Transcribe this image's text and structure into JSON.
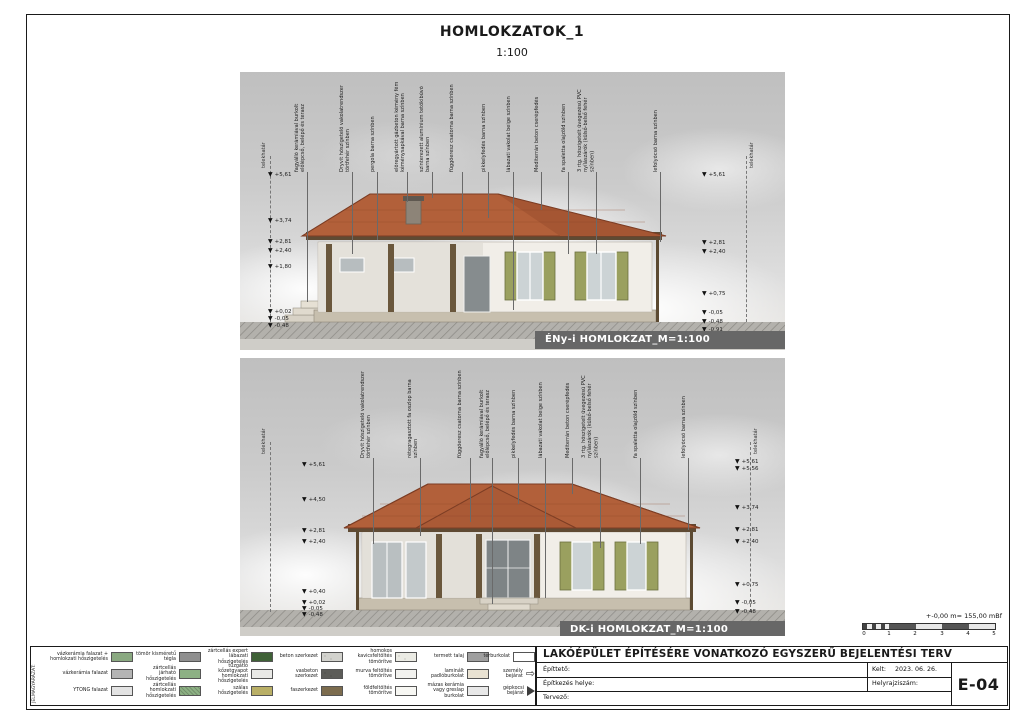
{
  "sheet": {
    "title": "HOMLOKZATOK_1",
    "scale": "1:100",
    "sheet_number": "E-04",
    "datum_note": "+-0,00 m= 155,00 mBf"
  },
  "icons": {
    "level_marker_glyph": "▼",
    "person_entrance_glyph": "⇨"
  },
  "elevations": [
    {
      "caption": "ÉNy-i HOMLOKZAT_M=1:100",
      "boundary_label": "telekhatár",
      "labels": [
        "fagyálló kerámiával burkolt előlépcső, belépő és terasz",
        "Dryvit hőszigetelő vakolatrendszer törtfehér színben",
        "pergola barna színben",
        "előregyártott gázbeton kémény fém kéménysapkával barna színben",
        "szinterezett alumínium tetőkibúvó barna színben",
        "függőeresz csatorna barna színben",
        "pikkelyfedés barna színben",
        "lábazati vakolat beige színben",
        "Mediterrán beton cserépfedés",
        "fa spaletta olajzöld színben",
        "3 rtg. hőszigetelt üvegezésű PVC nyílászárók (külső-belső fehér színben)",
        "lefolyócső barna színben"
      ],
      "levels_left": [
        "+5,61",
        "+3,74",
        "+2,81",
        "+2,40",
        "+1,80",
        "+0,02",
        "-0,05",
        "-0,48"
      ],
      "levels_right": [
        "+5,61",
        "+2,81",
        "+2,40",
        "+0,75",
        "-0,05",
        "-0,48",
        "-0,91"
      ]
    },
    {
      "caption": "DK-i HOMLOKZAT_M=1:100",
      "boundary_label": "telekhatár",
      "labels": [
        "Dryvit hőszigetelő vakolatrendszer törtfehér színben",
        "rétegragasztott fa oszlop barna színben",
        "függőeresz csatorna barna színben",
        "fagyálló kerámiával burkolt előlépcső, belépő és terasz",
        "pikkelyfedés barna színben",
        "lábazati vakolat beige színben",
        "Mediterrán beton cserépfedés",
        "3 rtg. hőszigetelt üvegezésű PVC nyílászárók (külső-belső fehér színben)",
        "fa spaletta olajzöld színben",
        "lefolyócső barna színben"
      ],
      "levels_left": [
        "+5,61",
        "+4,50",
        "+2,81",
        "+2,40",
        "+0,40",
        "+0,02",
        "-0,05",
        "-0,48"
      ],
      "levels_right": [
        "+5,61",
        "+5,56",
        "+3,74",
        "+2,81",
        "+2,40",
        "+0,75",
        "-0,05",
        "-0,48"
      ]
    }
  ],
  "legend": {
    "heading": "JELMAGYARÁZAT:",
    "items": [
      {
        "label": "vázkerámia falazat + homlokzati hőszigetelés",
        "color": "#8aa981"
      },
      {
        "label": "vázkerámia falazat",
        "color": "#b4b4b4"
      },
      {
        "label": "YTONG falazat",
        "color": "#e3e3e3"
      },
      {
        "label": "tömör kisméretű tégla",
        "color": "#8f8f8f"
      },
      {
        "label": "zártcellás járható hőszigetelés",
        "color": "#8db184"
      },
      {
        "label": "zártcellás homlokzati hőszigetelés",
        "color": "#8db184"
      },
      {
        "label": "zártcellás expert lábazati hőszigetelés",
        "color": "#3f6137"
      },
      {
        "label": "tűzgátló kőzetgyapot homlokzati hőszigetelés",
        "color": "#e9e9e6"
      },
      {
        "label": "szálas hőszigetelés",
        "color": "#b9af66"
      },
      {
        "label": "beton szerkezet",
        "color": "#d2d2cd"
      },
      {
        "label": "vasbeton szerkezet",
        "color": "#5c5c58"
      },
      {
        "label": "faszerkezet",
        "color": "#7c6c4e"
      },
      {
        "label": "homokos kavicsfeltöltés tömörítve",
        "color": "#ebebe4"
      },
      {
        "label": "murva feltöltés tömörítve",
        "color": "#f2f2ef"
      },
      {
        "label": "földfeltöltés tömörítve",
        "color": "#f7f7f3"
      },
      {
        "label": "termett talaj",
        "color": "#9f9f9f"
      },
      {
        "label": "térburkolat",
        "color": "#ffffff"
      },
      {
        "label": "laminált padlóburkolat",
        "color": "#e9e2d2"
      },
      {
        "label": "mázas kerámia vagy greslap burkolat",
        "color": "#e8e8e8"
      },
      {
        "label": "személy bejárat",
        "color": "#ffffff"
      },
      {
        "label": "gépkocsi bejárat",
        "color": "#3c3c3c"
      }
    ]
  },
  "titleblock": {
    "project_title": "LAKÓÉPÜLET ÉPÍTÉSÉRE VONATKOZÓ EGYSZERŰ BEJELENTÉSI TERV",
    "fields": [
      {
        "label": "Építtető:",
        "value": ""
      },
      {
        "label": "Építkezés helye:",
        "value": ""
      },
      {
        "label": "Tervező:",
        "value": ""
      }
    ],
    "kelt_label": "Kelt:",
    "kelt_value": "2023. 06. 26.",
    "helyrajzi_label": "Helyrajziszám:",
    "helyrajzi_value": ""
  },
  "scalebar": {
    "ticks": [
      "0",
      "1",
      "2",
      "3",
      "4",
      "5"
    ]
  }
}
